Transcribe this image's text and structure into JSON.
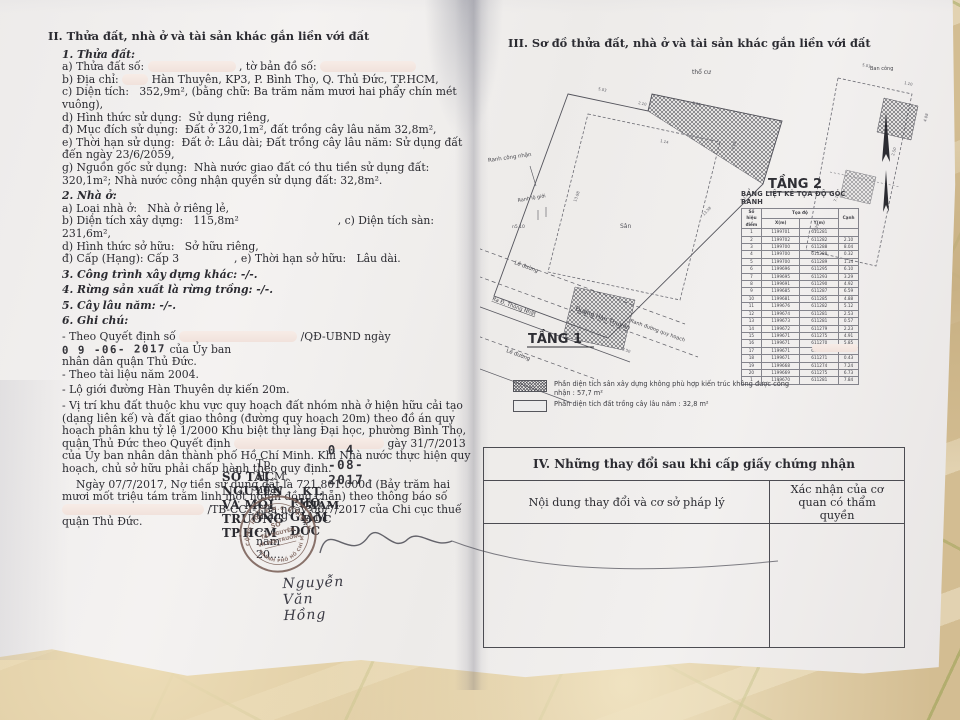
{
  "colors": {
    "stamp": "#7a6058",
    "ink": "#2b2b31",
    "paper": "#f2f0ef"
  },
  "left": {
    "sec2_title": "II. Thửa đất, nhà ở và tài sản khác gắn liền với đất",
    "t1h": "1. Thửa đất:",
    "t1a1": "a) Thửa đất số:",
    "t1a2": ", tờ bản đồ số:",
    "t1b1": "b) Địa chỉ:",
    "t1b2": "Hàn Thuyên, KP3, P. Bình Thọ, Q. Thủ Đức, TP.HCM,",
    "t1c1": "c) Diện tích:",
    "t1c2": "352,9m², (bằng chữ: Ba trăm năm mươi hai phẩy chín mét vuông),",
    "t1d1": "d) Hình thức sử dụng:",
    "t1d2": "Sử dụng riêng,",
    "t1dd1": "đ) Mục đích sử dụng:",
    "t1dd2": "Đất ở 320,1m², đất trồng cây lâu năm 32,8m²,",
    "t1e1": "e) Thời hạn sử dụng:",
    "t1e2": "Đất ở: Lâu dài; Đất trồng cây lâu năm: Sử dụng đất đến ngày 23/6/2059,",
    "t1g1": "g) Nguồn gốc sử dụng:",
    "t1g2": "Nhà nước giao đất có thu tiền sử dụng đất: 320,1m²; Nhà nước công nhận quyền sử dụng đất: 32,8m².",
    "t2h": "2. Nhà ở:",
    "t2a1": "a) Loại nhà ở:",
    "t2a2": "Nhà ở riêng lẻ,",
    "t2b1": "b) Diện tích xây dựng:",
    "t2b2": "115,8m²",
    "t2c1": ", c) Diện tích sàn:",
    "t2c2": "231,6m²,",
    "t2d1": "d) Hình thức sở hữu:",
    "t2d2": "Sở hữu riêng,",
    "t2dd1": "đ) Cấp (Hạng): Cấp 3",
    "t2e1": ", e) Thời hạn sở hữu:",
    "t2e2": "Lâu dài.",
    "t3": "3. Công trình xây dựng khác: -/-.",
    "t4": "4. Rừng sản xuất là rừng trồng: -/-.",
    "t5": "5. Cây lâu năm: -/-.",
    "t6": "6. Ghi chú:",
    "n1a": "- Theo Quyết định số",
    "n1b": "/QĐ-UBND ngày",
    "n1stamp": "0 9 -06- 2017",
    "n1c": "của Ủy ban",
    "n1d": "nhân dân quận Thủ Đức.",
    "n2": "- Theo tài liệu năm 2004.",
    "n3": "- Lộ giới đường Hàn Thuyên dự kiến 20m.",
    "n4a": "- Vị trí khu đất thuộc khu vực quy hoạch đất nhóm nhà ở hiện hữu cải tạo (dạng liên kế) và đất giao thông (đường quy hoạch 20m) theo đồ án quy hoạch phân khu tỷ lệ 1/2000 Khu biệt thự làng Đại học, phường Bình Thọ, quận Thủ Đức theo Quyết định",
    "n4b": "gày 31/7/2013 của Ủy ban nhân dân thành phố Hồ Chí Minh.",
    "n4c": "Khi Nhà nước thực hiện quy hoạch, chủ sở hữu phải chấp hành theo quy định.",
    "debt1": "Ngày 07/7/2017, Nợ tiền sử dụng đất là 721.801.000đ (Bảy trăm hai mươi mốt triệu tám trăm linh một nghìn đồng chẵn) theo thông báo số",
    "debt2": "/TB-CCT-TBa ngày 06/7/2017 của",
    "debt3": "Chi cục thuế quận Thủ Đức."
  },
  "sig": {
    "date_stamp": "0 4 -08- 2017",
    "place": "Tp. HCM, ngày ..... tháng ..... năm 20....",
    "org": "SỞ TÀI NGUYÊN VÀ MÔI TRƯỜNG TP.HCM",
    "kt": "KT. GIÁM ĐỐC",
    "deputy": "PHÓ GIÁM ĐỐC",
    "name": "Nguyễn Văn Hồng"
  },
  "stamp": {
    "arc_top": "CỘNG HÒA X.H.C.N VIỆT NAM",
    "arc_bottom": "THÀNH PHỐ HỒ CHÍ MINH",
    "l1": "SỞ",
    "l2": "TÀI NGUYÊN",
    "l3": "VÀ MÔI TRƯỜNG"
  },
  "plan": {
    "sec3_title": "III. Sơ đồ thửa đất, nhà ở và tài sản khác gắn liền với đất",
    "tho_cu": "thổ cư",
    "ranh_cong_nhan": "Ranh công nhận",
    "ranh_lo_gioi": "Ranh lộ giới",
    "ns10": "n5.10",
    "san": "Sân",
    "le_duong1": "Lề đường",
    "ra_d": "Ra Đ. Thống Nhất",
    "duong_han_thuyen": "Đường Hàn Thuyên",
    "le_duong2": "Lề đường",
    "ranh_quy_hoach": "Ranh đường quy hoạch",
    "tang1": "TẦNG 1",
    "tang2": "TẦNG 2",
    "ban_cong": "Ban công",
    "t1dims": [
      {
        "t": "5.03",
        "tf": "translate(118,40) rotate(12)"
      },
      {
        "t": "2.10",
        "tf": "translate(158,54) rotate(12)"
      },
      {
        "t": "8.04",
        "tf": "translate(212,54) rotate(12)"
      },
      {
        "t": "1.14",
        "tf": "translate(180,92) rotate(12)"
      },
      {
        "t": "4.08",
        "tf": "translate(254,100) rotate(-75)"
      },
      {
        "t": "13.98",
        "tf": "translate(96,152) rotate(-70)"
      },
      {
        "t": "13.58",
        "tf": "translate(224,166) rotate(-47)"
      },
      {
        "t": "7.13",
        "tf": "translate(262,152) rotate(-47)"
      },
      {
        "t": "4.98",
        "tf": "translate(98,262) rotate(20)"
      },
      {
        "t": "2.50",
        "tf": "translate(142,300) rotate(20)"
      }
    ],
    "t2dims": [
      {
        "t": "5.03",
        "tf": "translate(382,16) rotate(12)"
      },
      {
        "t": "1.10",
        "tf": "translate(424,34) rotate(12)"
      },
      {
        "t": "4.08",
        "tf": "translate(446,72) rotate(-75)"
      },
      {
        "t": "2.50",
        "tf": "translate(414,106) rotate(-75)"
      },
      {
        "t": "7.13",
        "tf": "translate(356,152) rotate(-70)"
      },
      {
        "t": "3.29",
        "tf": "translate(336,182) rotate(-70)"
      }
    ]
  },
  "coord_table": {
    "title": "BẢNG LIỆT KÊ TỌA ĐỘ GÓC RANH",
    "col_point": "Số hiệu",
    "col_point2": "điểm",
    "col_coords": "Tọa độ",
    "col_x": "X(m)",
    "col_y": "Y(m)",
    "col_edge": "Cạnh",
    "rows": [
      {
        "p": "1",
        "x": "1199701",
        "y": "611281",
        "c": ""
      },
      {
        "p": "2",
        "x": "1199702",
        "y": "611282",
        "c": "2.10"
      },
      {
        "p": "3",
        "x": "1199700",
        "y": "611288",
        "c": "8.04"
      },
      {
        "p": "4",
        "x": "1199700",
        "y": "611288",
        "c": "0.32"
      },
      {
        "p": "5",
        "x": "1199700",
        "y": "611289",
        "c": "1.14"
      },
      {
        "p": "6",
        "x": "1199696",
        "y": "611295",
        "c": "6.10"
      },
      {
        "p": "7",
        "x": "1199695",
        "y": "611293",
        "c": "3.29"
      },
      {
        "p": "8",
        "x": "1199691",
        "y": "611290",
        "c": "4.92"
      },
      {
        "p": "9",
        "x": "1199685",
        "y": "611287",
        "c": "6.59"
      },
      {
        "p": "10",
        "x": "1199681",
        "y": "611285",
        "c": "4.88"
      },
      {
        "p": "11",
        "x": "1199676",
        "y": "611282",
        "c": "5.12"
      },
      {
        "p": "12",
        "x": "1199674",
        "y": "611281",
        "c": "2.53"
      },
      {
        "p": "13",
        "x": "1199673",
        "y": "611281",
        "c": "0.57"
      },
      {
        "p": "14",
        "x": "1199672",
        "y": "611279",
        "c": "2.23"
      },
      {
        "p": "15",
        "x": "1199671",
        "y": "611275",
        "c": "4.91"
      },
      {
        "p": "16",
        "x": "1199671",
        "y": "611270",
        "c": "5.85"
      },
      {
        "p": "17",
        "x": "1199671",
        "y": "611271",
        "c": "2.82"
      },
      {
        "p": "18",
        "x": "1199671",
        "y": "611271",
        "c": "0.43"
      },
      {
        "p": "19",
        "x": "1199668",
        "y": "611274",
        "c": "7.24"
      },
      {
        "p": "20",
        "x": "1199669",
        "y": "611275",
        "c": "6.73"
      },
      {
        "p": "1",
        "x": "1199670",
        "y": "611281",
        "c": "7.84"
      }
    ]
  },
  "legend": {
    "item1": "Phần diện tích sân xây dựng không phù hợp kiến trúc không được công nhận : 57,7 m²",
    "item2": "Phần diện tích đất trồng cây lâu năm : 32,8 m²"
  },
  "sec4": {
    "title": "IV. Những thay đổi sau khi cấp giấy chứng nhận",
    "col1": "Nội dung thay đổi và cơ sở pháp lý",
    "col2": "Xác nhận của cơ quan có thẩm quyền"
  }
}
